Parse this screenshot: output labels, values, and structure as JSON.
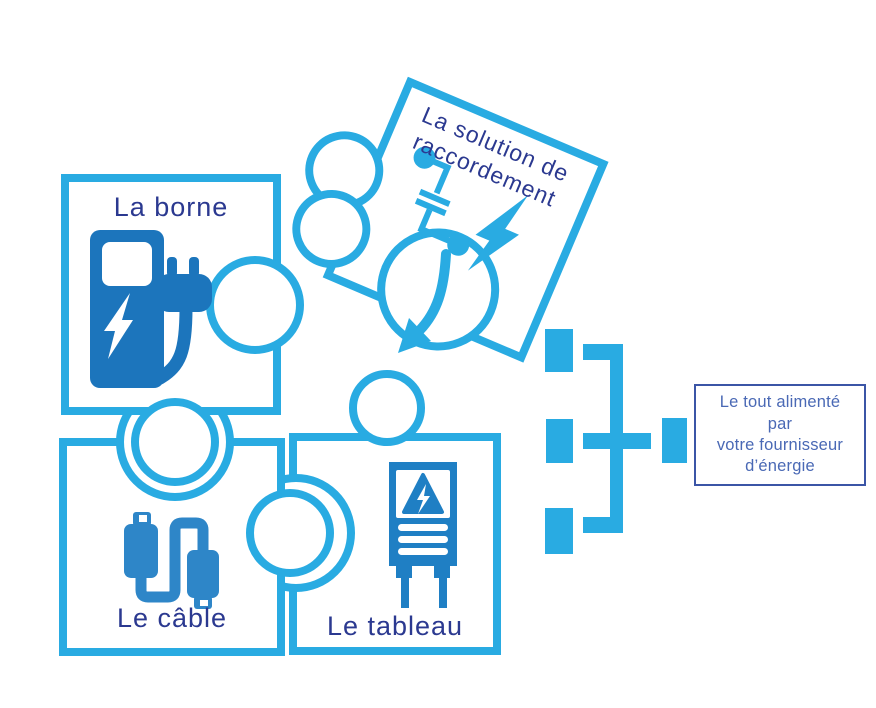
{
  "title": "Schéma de raccordement d'une borne de recharge",
  "colors": {
    "outline": "#29ABE2",
    "icon_dark": "#1C75BC",
    "icon_mid": "#2E86C8",
    "icon_panel": "#1F7FC4",
    "label": "#2B3990",
    "box_border": "#3B55A6",
    "box_text": "#4A69B5"
  },
  "pieces": {
    "borne": {
      "label": "La borne"
    },
    "cable": {
      "label": "Le câble"
    },
    "tableau": {
      "label": "Le tableau"
    },
    "solution": {
      "lines": [
        "La solution de",
        "raccordement"
      ]
    }
  },
  "supply_box": {
    "lines": [
      "Le tout alimenté",
      "par",
      "votre fournisseur",
      "d’énergie"
    ]
  },
  "icons": {
    "borne": "ev-charging-station-icon",
    "cable": "charging-cable-icon",
    "tableau": "electrical-panel-icon",
    "solution_switch": "disconnect-switch-icon",
    "solution_bolt": "lightning-bolt-icon",
    "arrow": "curved-arrow-icon",
    "connector": "power-supply-connector-icon"
  }
}
